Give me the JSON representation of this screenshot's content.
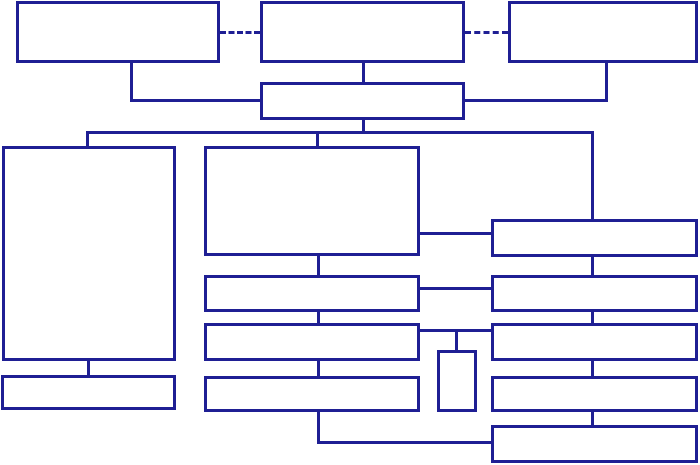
{
  "canvas": {
    "width": 700,
    "height": 465,
    "background": "#ffffff"
  },
  "style": {
    "line_color": "#1f1f94",
    "line_px": 3,
    "box_fill": "#ffffff"
  },
  "diagram": {
    "type": "flowchart",
    "description": "Unlabeled block diagram: three top boxes linked by dashed lines feed a hub bar; a main rail distributes to a left tall box, a center large box with three bars below, and a column of five right bars; a small vertical box hangs between the center and right columns; all boxes are empty with navy borders on white.",
    "nodes": [
      {
        "id": "top-left-box",
        "x": 16,
        "y": 1,
        "w": 204,
        "h": 62
      },
      {
        "id": "top-center-box",
        "x": 260,
        "y": 1,
        "w": 205,
        "h": 62
      },
      {
        "id": "top-right-box",
        "x": 508,
        "y": 1,
        "w": 190,
        "h": 62
      },
      {
        "id": "hub-box",
        "x": 260,
        "y": 82,
        "w": 205,
        "h": 38
      },
      {
        "id": "left-tall-box",
        "x": 2,
        "y": 146,
        "w": 174,
        "h": 215
      },
      {
        "id": "left-bottom-bar",
        "x": 1,
        "y": 375,
        "w": 175,
        "h": 35
      },
      {
        "id": "center-large-box",
        "x": 204,
        "y": 146,
        "w": 216,
        "h": 110
      },
      {
        "id": "center-bar-1",
        "x": 204,
        "y": 275,
        "w": 216,
        "h": 37
      },
      {
        "id": "center-bar-2",
        "x": 204,
        "y": 323,
        "w": 216,
        "h": 38
      },
      {
        "id": "center-bar-3",
        "x": 204,
        "y": 376,
        "w": 216,
        "h": 36
      },
      {
        "id": "small-vertical-box",
        "x": 437,
        "y": 350,
        "w": 40,
        "h": 62
      },
      {
        "id": "right-bar-1",
        "x": 491,
        "y": 219,
        "w": 207,
        "h": 38
      },
      {
        "id": "right-bar-2",
        "x": 491,
        "y": 275,
        "w": 207,
        "h": 37
      },
      {
        "id": "right-bar-3",
        "x": 491,
        "y": 323,
        "w": 207,
        "h": 38
      },
      {
        "id": "right-bar-4",
        "x": 491,
        "y": 376,
        "w": 207,
        "h": 36
      },
      {
        "id": "right-bar-5",
        "x": 491,
        "y": 425,
        "w": 207,
        "h": 38
      }
    ],
    "connectors": [
      {
        "id": "dashed-link-left",
        "kind": "h",
        "x": 220,
        "y": 31,
        "len": 40,
        "dashed": true
      },
      {
        "id": "dashed-link-right",
        "kind": "h",
        "x": 465,
        "y": 31,
        "len": 43,
        "dashed": true
      },
      {
        "id": "topleft-drop",
        "kind": "v",
        "x": 130,
        "y": 63,
        "len": 39
      },
      {
        "id": "topleft-elbow",
        "kind": "h",
        "x": 130,
        "y": 99,
        "len": 133
      },
      {
        "id": "topcenter-drop",
        "kind": "v",
        "x": 362,
        "y": 63,
        "len": 19
      },
      {
        "id": "topright-drop",
        "kind": "v",
        "x": 605,
        "y": 63,
        "len": 39
      },
      {
        "id": "topright-elbow",
        "kind": "h",
        "x": 465,
        "y": 99,
        "len": 143
      },
      {
        "id": "hub-drop",
        "kind": "v",
        "x": 362,
        "y": 120,
        "len": 14
      },
      {
        "id": "main-rail",
        "kind": "h",
        "x": 86,
        "y": 131,
        "len": 508
      },
      {
        "id": "rail-drop-left",
        "kind": "v",
        "x": 86,
        "y": 131,
        "len": 15
      },
      {
        "id": "rail-drop-center",
        "kind": "v",
        "x": 316,
        "y": 131,
        "len": 15
      },
      {
        "id": "rail-drop-right",
        "kind": "v",
        "x": 591,
        "y": 131,
        "len": 88
      },
      {
        "id": "center-right-link-1",
        "kind": "h",
        "x": 420,
        "y": 232,
        "len": 71
      },
      {
        "id": "center-chain-1",
        "kind": "v",
        "x": 317,
        "y": 256,
        "len": 19
      },
      {
        "id": "center-right-link-2",
        "kind": "h",
        "x": 420,
        "y": 287,
        "len": 71
      },
      {
        "id": "right-chain-1",
        "kind": "v",
        "x": 591,
        "y": 257,
        "len": 18
      },
      {
        "id": "center-chain-2",
        "kind": "v",
        "x": 317,
        "y": 312,
        "len": 11
      },
      {
        "id": "center-right-link-3",
        "kind": "h",
        "x": 420,
        "y": 329,
        "len": 71
      },
      {
        "id": "small-box-stub",
        "kind": "v",
        "x": 455,
        "y": 330,
        "len": 20
      },
      {
        "id": "right-chain-2",
        "kind": "v",
        "x": 591,
        "y": 312,
        "len": 11
      },
      {
        "id": "center-chain-3",
        "kind": "v",
        "x": 317,
        "y": 361,
        "len": 15
      },
      {
        "id": "right-chain-3",
        "kind": "v",
        "x": 591,
        "y": 361,
        "len": 15
      },
      {
        "id": "center-bottom-drop",
        "kind": "v",
        "x": 317,
        "y": 412,
        "len": 32
      },
      {
        "id": "bottom-rail",
        "kind": "h",
        "x": 317,
        "y": 441,
        "len": 174
      },
      {
        "id": "right-chain-4",
        "kind": "v",
        "x": 591,
        "y": 412,
        "len": 13
      },
      {
        "id": "left-bar-link",
        "kind": "v",
        "x": 87,
        "y": 361,
        "len": 14
      }
    ]
  }
}
